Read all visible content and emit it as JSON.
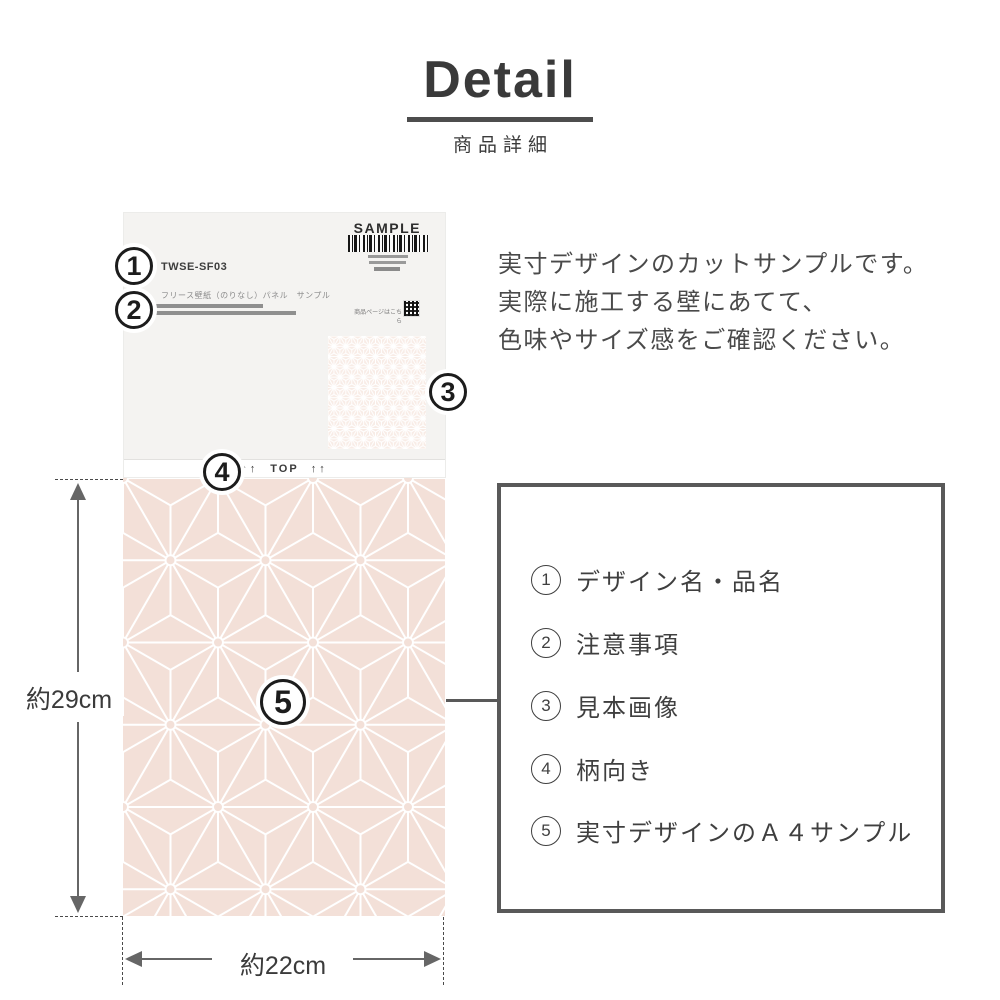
{
  "page": {
    "title": "Detail",
    "subtitle": "商品詳細"
  },
  "description": {
    "line1": "実寸デザインのカットサンプルです。",
    "line2": "実際に施工する壁にあてて、",
    "line3": "色味やサイズ感をご確認ください。"
  },
  "sample_card": {
    "sample_label": "SAMPLE",
    "product_code": "TWSE-SF03",
    "product_type": "フリース壁紙（のりなし）パネル　サンプル",
    "qr_caption": "商品ページはこちら",
    "top_marker": {
      "arrows_left": "↑↑",
      "label": "TOP",
      "arrows_right": "↑↑"
    }
  },
  "callouts": {
    "c1": "1",
    "c2": "2",
    "c3": "3",
    "c4": "4",
    "c5": "5"
  },
  "dimensions": {
    "height_label": "約29cm",
    "width_label": "約22cm"
  },
  "legend": {
    "items": [
      {
        "digit": "1",
        "label": "デザイン名・品名"
      },
      {
        "digit": "2",
        "label": "注意事項"
      },
      {
        "digit": "3",
        "label": "見本画像"
      },
      {
        "digit": "4",
        "label": "柄向き"
      },
      {
        "digit": "5",
        "label": "実寸デザインのＡ４サンプル"
      }
    ]
  },
  "colors": {
    "pattern_base": "#f3e0d8",
    "swatch_base": "#f8ece6",
    "line_gray": "#595959",
    "text_dark": "#3f3f3f"
  }
}
